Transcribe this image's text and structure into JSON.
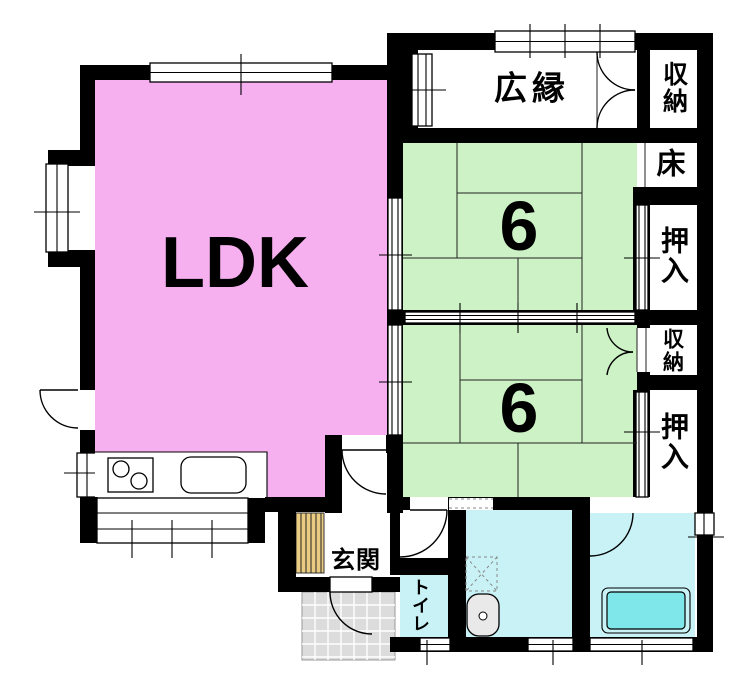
{
  "palette": {
    "wall": "#000000",
    "ldk_fill": "#F6AFEF",
    "tatami_fill": "#CDF2C5",
    "wet_fill": "#C9F2F6",
    "tub_fill": "#7FE6EA",
    "step_fill": "#EACB82",
    "porch_fill": "#DCDCDC"
  },
  "rooms": {
    "ldk": {
      "label": "LDK"
    },
    "tatami_north": {
      "label": "6"
    },
    "tatami_south": {
      "label": "6"
    },
    "hiroen": {
      "label": "広縁"
    },
    "storage_north": {
      "label": "収納"
    },
    "toko": {
      "label": "床"
    },
    "oshiire_north": {
      "label": "押入"
    },
    "storage_middle": {
      "label": "収納"
    },
    "oshiire_south": {
      "label": "押入"
    },
    "genkan": {
      "label": "玄関"
    },
    "toilet": {
      "label": "トイレ"
    }
  }
}
